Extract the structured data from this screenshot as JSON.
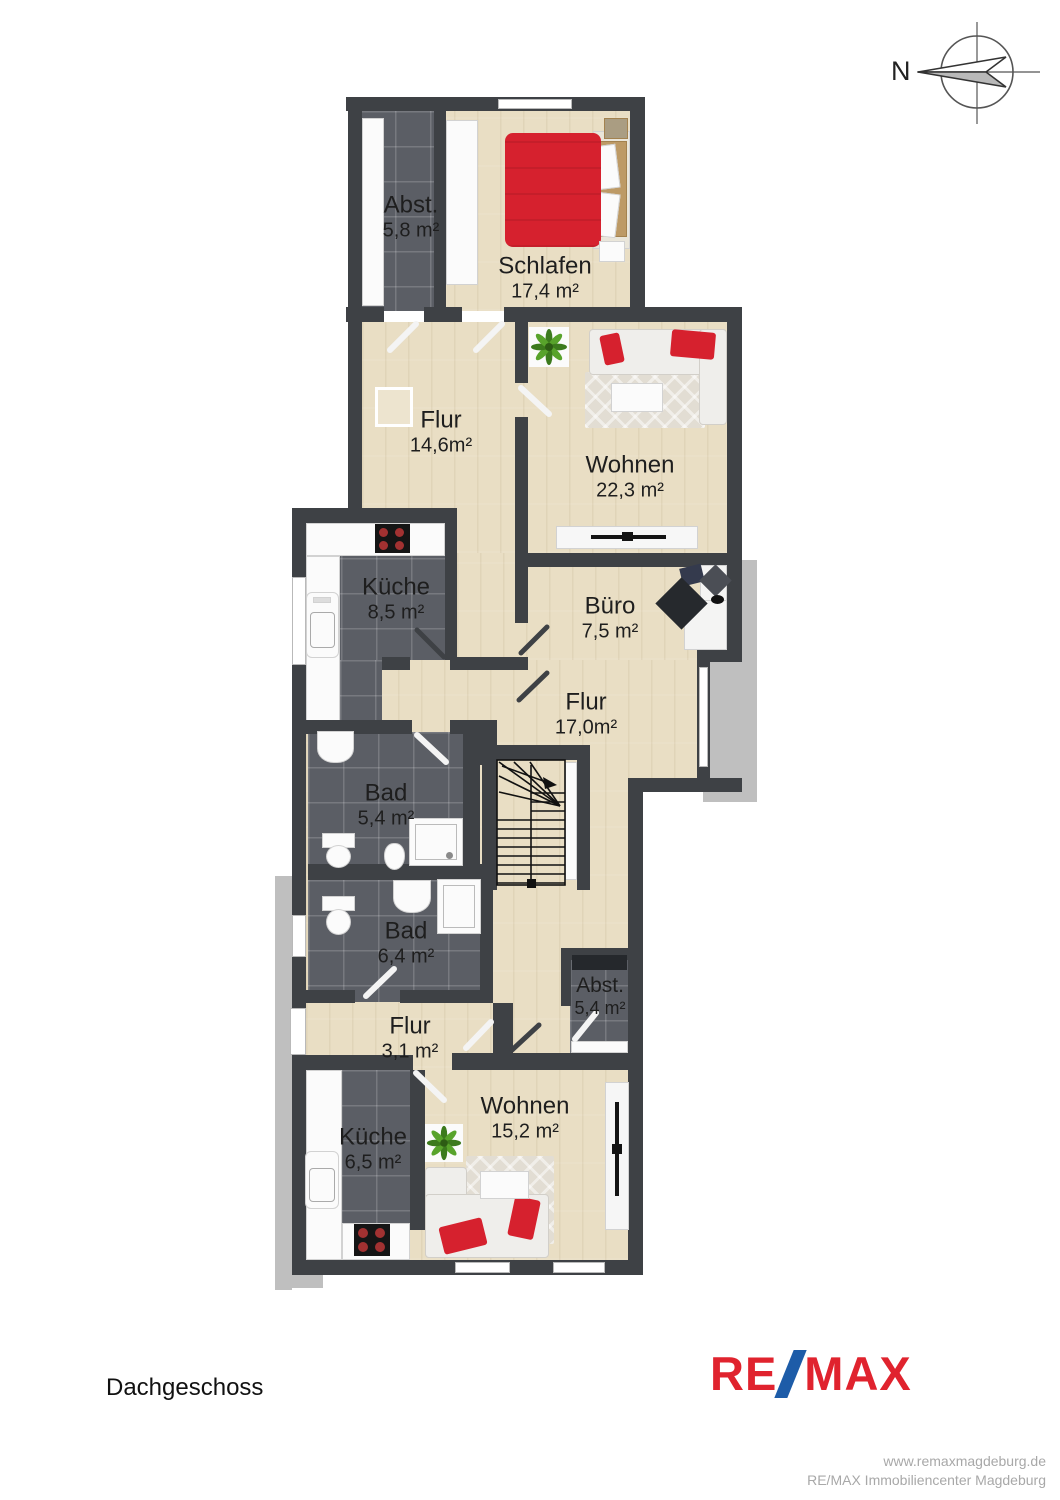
{
  "document": {
    "floor_label": "Dachgeschoss",
    "compass": {
      "north_label": "N"
    }
  },
  "rooms": [
    {
      "name": "Abst.",
      "area": "5,8 m²"
    },
    {
      "name": "Schlafen",
      "area": "17,4 m²"
    },
    {
      "name": "Flur",
      "area": "14,6m²"
    },
    {
      "name": "Wohnen",
      "area": "22,3 m²"
    },
    {
      "name": "Küche",
      "area": "8,5 m²"
    },
    {
      "name": "Büro",
      "area": "7,5 m²"
    },
    {
      "name": "Flur",
      "area": "17,0m²"
    },
    {
      "name": "Bad",
      "area": "5,4 m²"
    },
    {
      "name": "Bad",
      "area": "6,4 m²"
    },
    {
      "name": "Abst.",
      "area": "5,4 m²"
    },
    {
      "name": "Flur",
      "area": "3,1 m²"
    },
    {
      "name": "Küche",
      "area": "6,5 m²"
    },
    {
      "name": "Wohnen",
      "area": "15,2 m²"
    }
  ],
  "branding": {
    "logo": {
      "re": "RE",
      "slash": "/",
      "max": "MAX"
    },
    "website": "www.remaxmagdeburg.de",
    "company": "RE/MAX Immobiliencenter Magdeburg",
    "colors": {
      "brand_red": "#e0232e",
      "brand_blue": "#1d5ca8"
    }
  }
}
